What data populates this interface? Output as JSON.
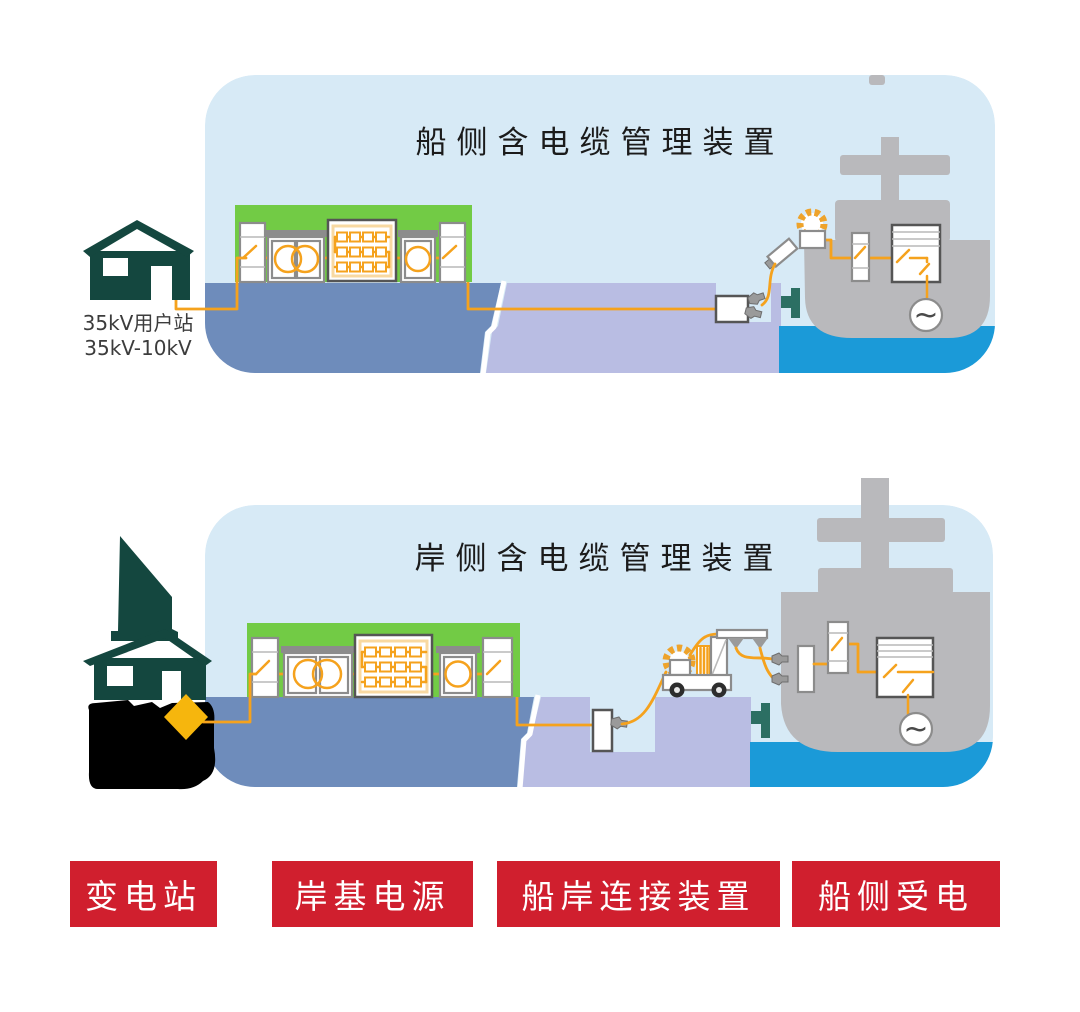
{
  "colors": {
    "panel_bg": "#d7eaf6",
    "platform": "#6e8cbb",
    "dock": "#b9bde3",
    "water": "#1b9ad8",
    "green": "#72cb45",
    "ship": "#b9b9bc",
    "building": "#14473f",
    "bollard": "#2c6f63",
    "cable": "#f5a21d",
    "reel": "#eea32b",
    "glow": "#f8d9a2",
    "gold": "#f6b60d",
    "red": "#d01f2e",
    "outline": "#8c8c8c",
    "outline_dark": "#555555",
    "title": "#1b1b1b",
    "sub_label": "#3c3c3c",
    "label_text": "#ffffff",
    "black": "#000000"
  },
  "panel1": {
    "title": "船侧含电缆管理装置",
    "substation_line1": "35kV用户站",
    "substation_line2": "35kV-10kV"
  },
  "panel2": {
    "title": "岸侧含电缆管理装置"
  },
  "legend": {
    "items": [
      {
        "label": "变电站"
      },
      {
        "label": "岸基电源"
      },
      {
        "label": "船岸连接装置"
      },
      {
        "label": "船侧受电"
      }
    ]
  },
  "icons": {
    "generator": "~"
  }
}
